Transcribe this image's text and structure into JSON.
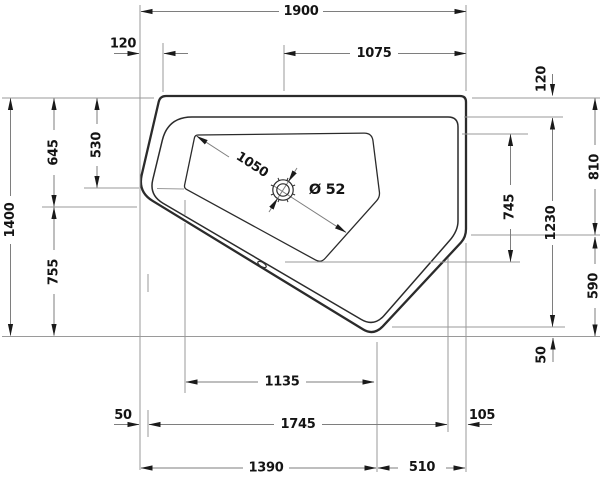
{
  "drawing": {
    "kind": "bathtub plan technical drawing",
    "background_color": "#ffffff",
    "outline_color": "#2b2b2b",
    "dimension_line_color": "#7e7e7e",
    "text_color": "#141414"
  },
  "dimensions": {
    "overall_width": "1900",
    "top_left_offset": "120",
    "drain_to_right_edge": "1075",
    "overall_depth": "1400",
    "left_upper": "645",
    "basin_left_top": "530",
    "left_lower": "755",
    "rim_top_right": "120",
    "right_upper": "810",
    "basin_depth": "745",
    "inner_right": "1230",
    "right_lower": "590",
    "rim_bottom_right": "50",
    "basin_width": "1135",
    "rim_left_bottom": "50",
    "inner_width": "1745",
    "bottom_right_offset": "105",
    "bottom_left_span": "1390",
    "bottom_right_span": "510",
    "basin_diagonal": "1050",
    "drain_diameter": "Ø 52"
  }
}
